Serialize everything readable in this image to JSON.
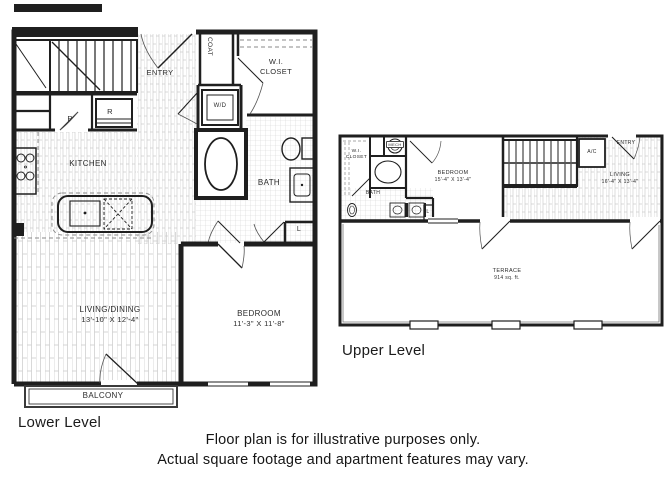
{
  "page": {
    "background": "#ffffff",
    "ink": "#1f1f1f",
    "hatch_color": "#c9c9c9",
    "disclaimer_line1": "Floor plan is for illustrative purposes only.",
    "disclaimer_line2": "Actual square footage and apartment features may vary."
  },
  "lower_level": {
    "caption": "Lower Level",
    "rooms": {
      "entry": "ENTRY",
      "coat": "COAT",
      "wi_closet_line1": "W.I.",
      "wi_closet_line2": "CLOSET",
      "washer_dryer": "W/D",
      "pantry": "P",
      "refrigerator": "R",
      "kitchen": "KITCHEN",
      "bath": "BATH",
      "linen": "L",
      "living_dining": "LIVING/DINING",
      "living_dining_dims": "13'-10\" X 12'-4\"",
      "bedroom": "BEDROOM",
      "bedroom_dims": "11'-3\" X 11'-8\"",
      "balcony": "BALCONY"
    }
  },
  "upper_level": {
    "caption": "Upper Level",
    "rooms": {
      "wi_closet_line1": "W.I.",
      "wi_closet_line2": "CLOSET",
      "mech": "MECH",
      "bath": "BATH",
      "linen": "L",
      "bedroom": "BEDROOM",
      "bedroom_dims": "15'-4\" X 13'-4\"",
      "ac": "A/C",
      "entry": "ENTRY",
      "living": "LIVING",
      "living_dims": "16'-4\" X 13'-4\"",
      "terrace": "TERRACE",
      "terrace_area": "914 sq. ft."
    }
  }
}
